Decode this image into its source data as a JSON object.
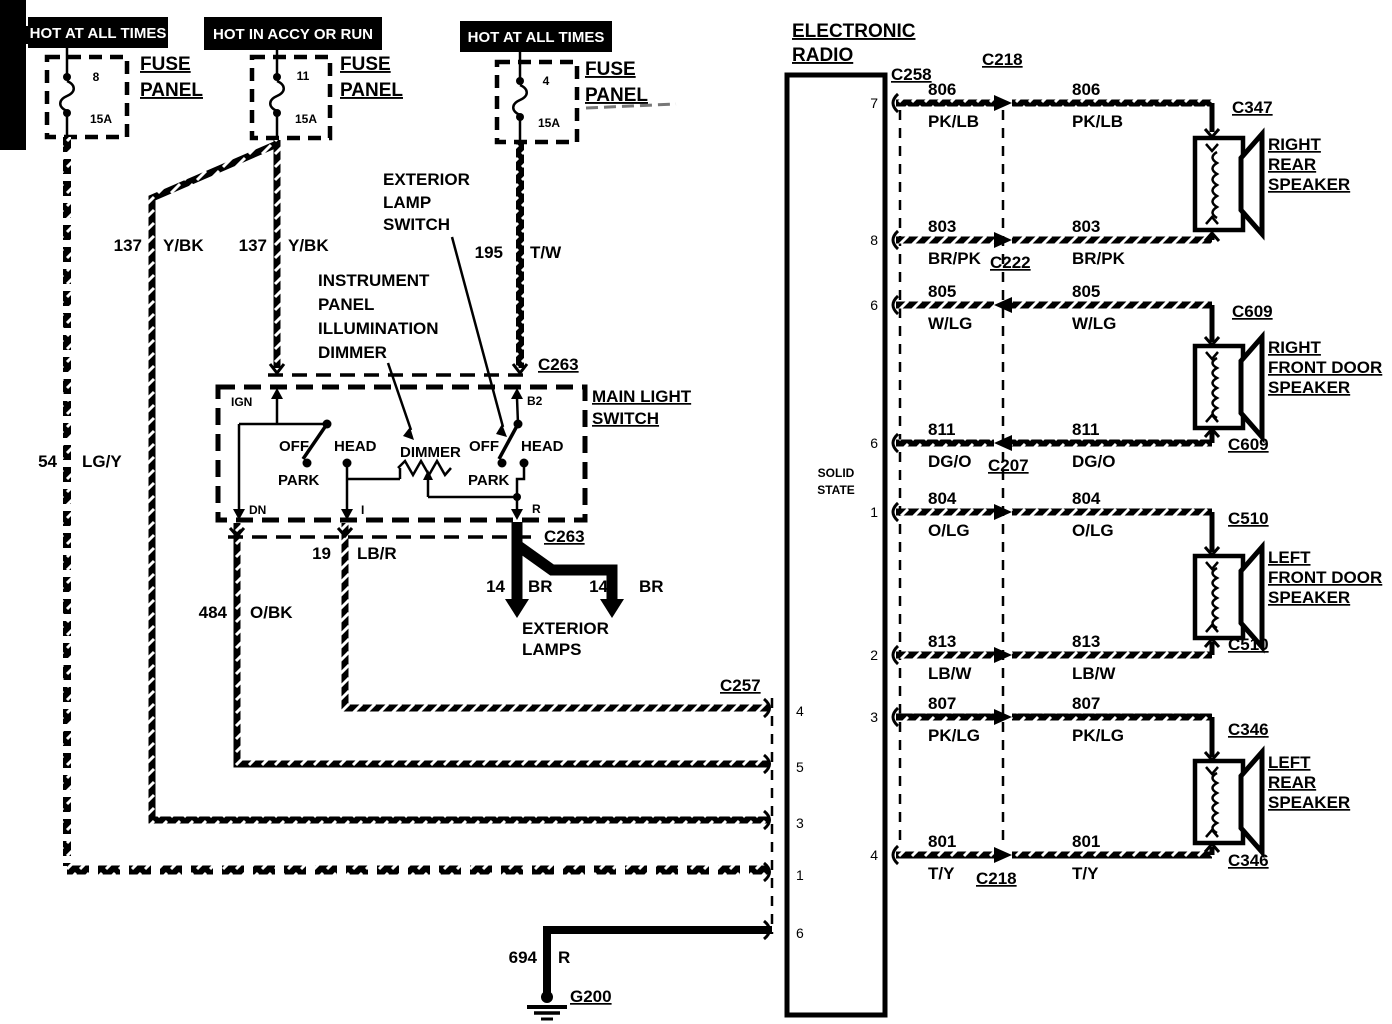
{
  "banners": [
    {
      "text": "HOT AT ALL TIMES"
    },
    {
      "text": "HOT IN ACCY OR RUN"
    },
    {
      "text": "HOT AT ALL TIMES"
    }
  ],
  "fuse_label": {
    "line1": "FUSE",
    "line2": "PANEL"
  },
  "fuses": [
    {
      "number": "8",
      "amps": "15A"
    },
    {
      "number": "11",
      "amps": "15A"
    },
    {
      "number": "4",
      "amps": "15A"
    }
  ],
  "wires": {
    "w137a": {
      "num": "137",
      "color": "Y/BK"
    },
    "w137b": {
      "num": "137",
      "color": "Y/BK"
    },
    "w195": {
      "num": "195",
      "color": "T/W"
    },
    "w54": {
      "num": "54",
      "color": "LG/Y"
    },
    "w484": {
      "num": "484",
      "color": "O/BK"
    },
    "w19": {
      "num": "19",
      "color": "LB/R"
    },
    "w14a": {
      "num": "14",
      "color": "BR"
    },
    "w14b": {
      "num": "14",
      "color": "BR"
    },
    "w694": {
      "num": "694",
      "color": "R"
    }
  },
  "annotations": {
    "exterior_lamp_switch": [
      "EXTERIOR",
      "LAMP",
      "SWITCH"
    ],
    "instrument_dimmer": [
      "INSTRUMENT",
      "PANEL",
      "ILLUMINATION",
      "DIMMER"
    ],
    "main_light_switch": [
      "MAIN LIGHT",
      "SWITCH"
    ],
    "exterior_lamps": [
      "EXTERIOR",
      "LAMPS"
    ]
  },
  "light_switch": {
    "pin_ign": "IGN",
    "pin_b2": "B2",
    "pin_dn": "DN",
    "pin_i": "I",
    "pin_r": "R",
    "left": {
      "off": "OFF",
      "head": "HEAD",
      "park": "PARK"
    },
    "right": {
      "off": "OFF",
      "head": "HEAD",
      "park": "PARK"
    },
    "dimmer": "DIMMER"
  },
  "connectors": {
    "c263_top": "C263",
    "c263_bottom": "C263",
    "c257": "C257",
    "c258": "C258",
    "c218_top": "C218",
    "g200": "G200"
  },
  "radio": {
    "title": [
      "ELECTRONIC",
      "RADIO"
    ],
    "solid_state": [
      "SOLID",
      "STATE"
    ],
    "left_pins": [
      "4",
      "5",
      "3",
      "1",
      "6"
    ]
  },
  "rows": [
    {
      "pin": "7",
      "num": "806",
      "color": "PK/LB",
      "num2": "806",
      "color2": "PK/LB",
      "conn": "C347"
    },
    {
      "pin": "8",
      "num": "803",
      "color": "BR/PK",
      "num2": "803",
      "color2": "BR/PK",
      "mid": "C222"
    },
    {
      "pin": "6",
      "num": "805",
      "color": "W/LG",
      "num2": "805",
      "color2": "W/LG",
      "conn": "C609"
    },
    {
      "pin": "6",
      "num": "811",
      "color": "DG/O",
      "num2": "811",
      "color2": "DG/O",
      "mid": "C207",
      "conn": "C609"
    },
    {
      "pin": "1",
      "num": "804",
      "color": "O/LG",
      "num2": "804",
      "color2": "O/LG",
      "conn": "C510"
    },
    {
      "pin": "2",
      "num": "813",
      "color": "LB/W",
      "num2": "813",
      "color2": "LB/W",
      "conn": "C510"
    },
    {
      "pin": "3",
      "num": "807",
      "color": "PK/LG",
      "num2": "807",
      "color2": "PK/LG",
      "conn": "C346"
    },
    {
      "pin": "4",
      "num": "801",
      "color": "T/Y",
      "num2": "801",
      "color2": "T/Y",
      "mid": "C218",
      "conn": "C346"
    }
  ],
  "speakers": [
    {
      "lines": [
        "RIGHT",
        "REAR",
        "SPEAKER"
      ]
    },
    {
      "lines": [
        "RIGHT",
        "FRONT DOOR",
        "SPEAKER"
      ]
    },
    {
      "lines": [
        "LEFT",
        "FRONT DOOR",
        "SPEAKER"
      ]
    },
    {
      "lines": [
        "LEFT",
        "REAR",
        "SPEAKER"
      ]
    }
  ]
}
